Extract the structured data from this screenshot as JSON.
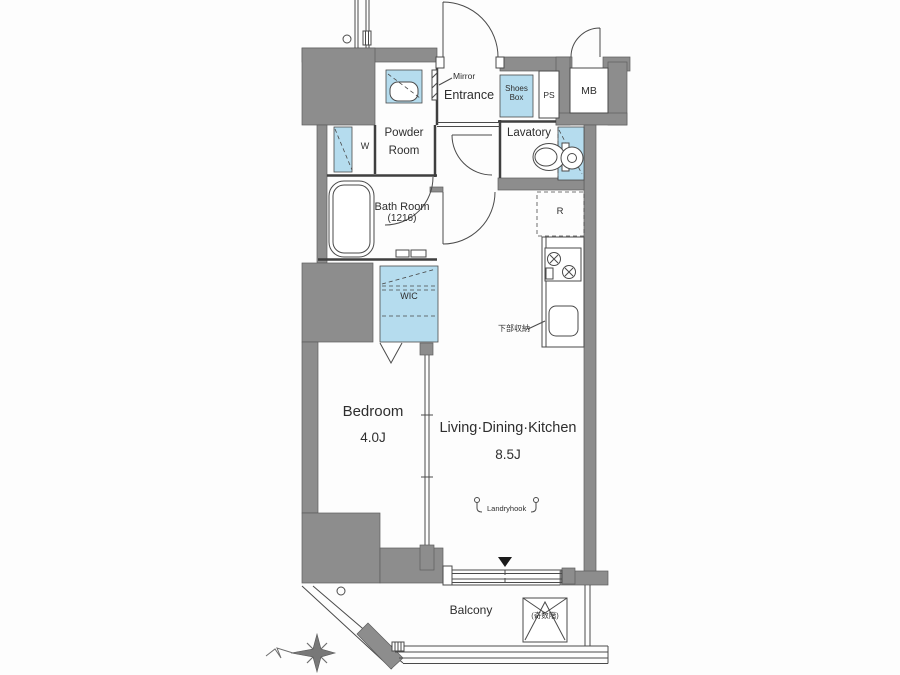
{
  "colors": {
    "wall_gray": "#8d8d8d",
    "fixture_blue": "#b5dcee",
    "line": "#4a4a4a",
    "background": "#ffffff"
  },
  "plan": {
    "entrance": {
      "label": "Entrance",
      "mirror_label": "Mirror",
      "shoes_box_line1": "Shoes",
      "shoes_box_line2": "Box",
      "ps_label": "PS",
      "mb_label": "MB"
    },
    "powder_room": {
      "line1": "Powder",
      "line2": "Room",
      "washer_label": "W"
    },
    "lavatory": {
      "label": "Lavatory"
    },
    "bath_room": {
      "line1": "Bath Room",
      "line2": "(1216)"
    },
    "kitchen": {
      "fridge_label": "R",
      "under_storage_label": "下部収納"
    },
    "wic": {
      "label": "WIC"
    },
    "bedroom": {
      "label": "Bedroom",
      "size": "4.0J"
    },
    "ldk": {
      "label": "Living·Dining·Kitchen",
      "size": "8.5J",
      "laundry_hook_label": "Landryhook"
    },
    "balcony": {
      "label": "Balcony",
      "hatch_label": "(奇数階)"
    }
  }
}
